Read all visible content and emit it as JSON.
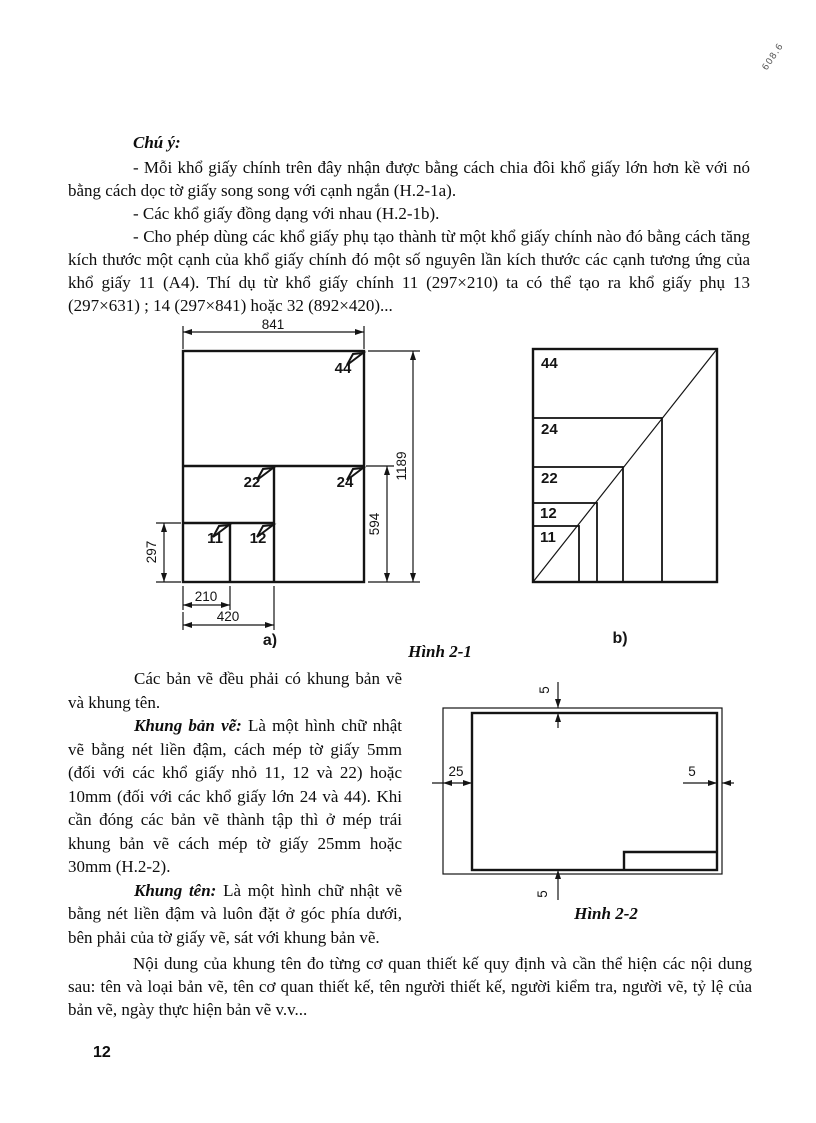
{
  "page": {
    "number": "12",
    "corner_mark": "608.6"
  },
  "notes": {
    "heading": "Chú ý:",
    "items": [
      "- Mỗi khổ giấy chính trên đây nhận được bằng cách chia đôi khổ giấy lớn hơn kề với nó bằng cách dọc tờ giấy song song với cạnh ngắn (H.2-1a).",
      "- Các khổ giấy đồng dạng với nhau (H.2-1b).",
      "- Cho phép dùng các khổ giấy phụ tạo thành từ một khổ giấy chính nào đó bằng cách tăng kích thước một cạnh của khổ giấy chính đó một số nguyên lần kích thước các cạnh tương ứng của khổ giấy 11 (A4). Thí dụ từ khổ giấy chính 11 (297×210) ta có thể tạo ra khổ giấy phụ 13 (297×631) ; 14 (297×841) hoặc 32 (892×420)..."
    ]
  },
  "figure1": {
    "caption": "Hình 2-1",
    "sub_a": "a)",
    "sub_b": "b)",
    "dim_841": "841",
    "dim_1189": "1189",
    "dim_594": "594",
    "dim_297": "297",
    "dim_210": "210",
    "dim_420": "420",
    "a_labels": {
      "f44": "44",
      "f22": "22",
      "f24": "24",
      "f11": "11",
      "f12": "12"
    },
    "b_labels": {
      "f44": "44",
      "f24": "24",
      "f22": "22",
      "f12": "12",
      "f11": "11"
    }
  },
  "body": {
    "p1": "Các bản vẽ đều phải có khung bản vẽ và khung tên.",
    "p2_term": "Khung bản vẽ:",
    "p2_text": " Là một hình chữ nhật vẽ bằng nét liền đậm, cách mép tờ giấy 5mm (đối với các khổ giấy nhỏ 11, 12 và 22) hoặc 10mm (đối với các khổ giấy lớn 24 và 44). Khi cần đóng các bản vẽ thành tập thì ở mép trái khung bản vẽ cách mép tờ giấy 25mm hoặc 30mm (H.2-2).",
    "p3_term": "Khung tên:",
    "p3_text": " Là một hình chữ nhật vẽ bằng nét liền đậm và luôn đặt ở góc phía dưới, bên phải của tờ giấy vẽ, sát với khung bản vẽ.",
    "p4": "Nội dung của khung tên đo từng cơ quan thiết kế quy định và cần thể hiện các nội dung sau: tên và loại bản vẽ, tên cơ quan thiết kế, tên người thiết kế, người kiểm tra, người vẽ, tỷ lệ của bản vẽ, ngày thực hiện bản vẽ v.v..."
  },
  "figure2": {
    "caption": "Hình 2-2",
    "dim_top": "5",
    "dim_left": "25",
    "dim_right": "5",
    "dim_bottom": "5"
  }
}
